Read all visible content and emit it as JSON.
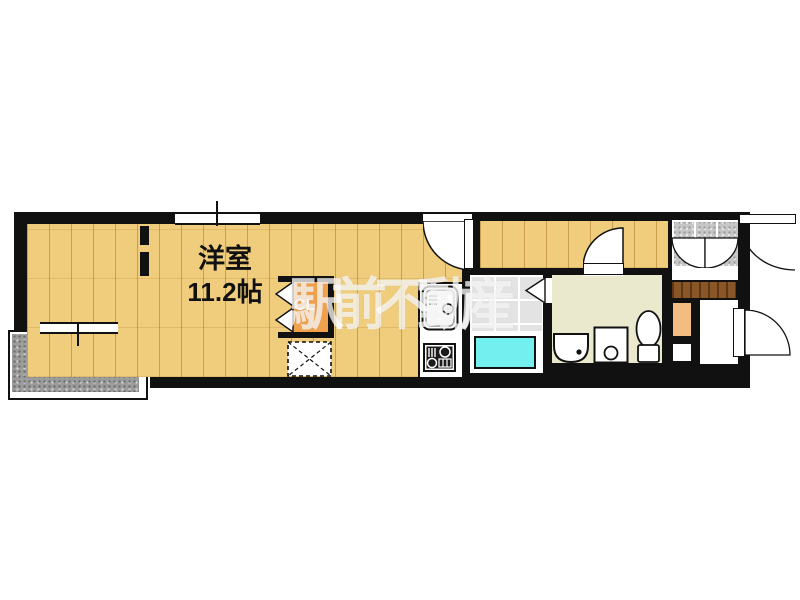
{
  "watermark": "駅前不動産",
  "plan": {
    "living_room": {
      "name": "洋室",
      "size": "11.2帖"
    },
    "balcony": {
      "name": "バルコニー"
    },
    "closet": {
      "name": "CL"
    }
  },
  "fixtures": [
    "kitchen-sink",
    "gas-stove",
    "bathtub",
    "toilet",
    "washbasin",
    "washing-machine-space",
    "refrigerator-space",
    "shoe-cabinet",
    "closet-bifold-door",
    "bathroom-folding-door",
    "closet-folding-door",
    "entrance-door",
    "exterior-door",
    "room-door",
    "sanitary-door",
    "window",
    "balcony-window",
    "wall-stub"
  ],
  "colors": {
    "wall": "#111111",
    "wood_floor": "#f0cd7c",
    "balcony_gray": "#9c9c9c",
    "bath_tile_gray": "#e3e3e3",
    "bathtub_cyan": "#74efef",
    "closet_orange": "#f0a14d",
    "step_tan": "#f3bd81",
    "shoe_cabinet_brown": "#8a5527",
    "sanitary_cream": "#ebe9cd",
    "entrance_tile_gray": "#c6c6c6",
    "watermark_white": "#ffffff"
  }
}
